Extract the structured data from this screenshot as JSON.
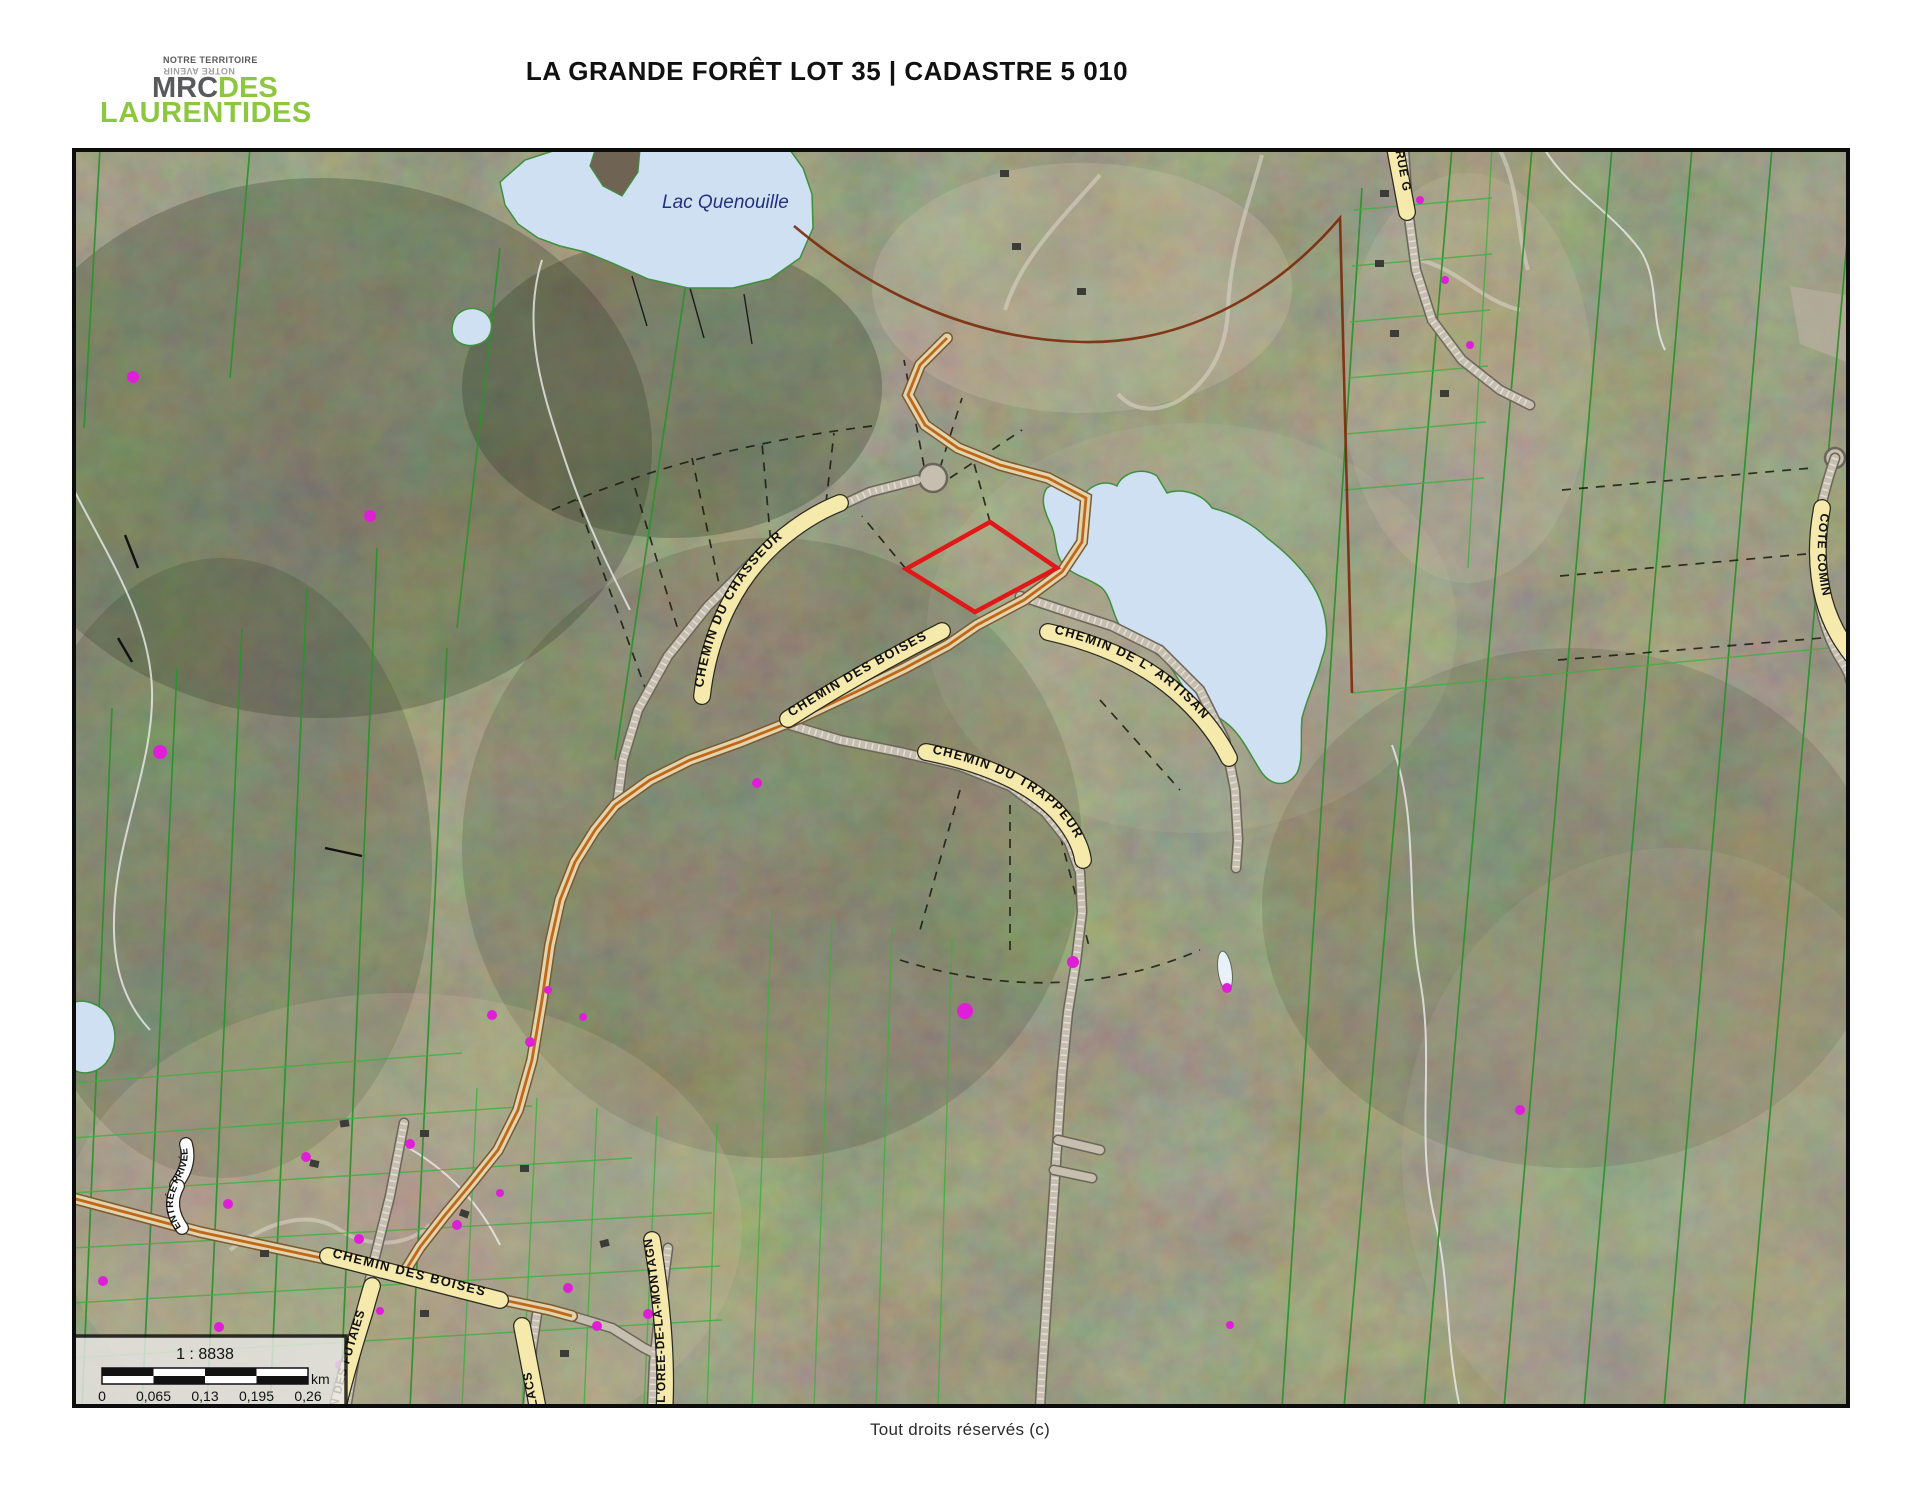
{
  "header": {
    "logo": {
      "tagline1": "NOTRE TERRITOIRE",
      "tagline2": "NOTRE AVENIR",
      "mrc": "MRC",
      "des": "DES",
      "region": "LAURENTIDES"
    },
    "title": "LA GRANDE FORÊT LOT 35 | CADASTRE 5 010"
  },
  "map": {
    "water_labels": {
      "lac_quenouille": "Lac Quenouille"
    },
    "road_labels": {
      "chasseur": "CHEMIN DU CHASSEUR",
      "boises_upper": "CHEMIN DES BOISES",
      "artisan": "CHEMIN DE L' ARTISAN",
      "trappeur": "CHEMIN DU TRAPPEUR",
      "boises_lower": "CHEMIN DES BOISES",
      "futaies": "IN DES FUTAIES",
      "lacs": "LACS",
      "oree": "E L'OREE-DE-LA-MONTAGNE",
      "rue_g": "RUE G",
      "cote": "COTE COMIN",
      "entree": "ENTRÉE",
      "privee": "PRIVÉE"
    },
    "scale_bar": {
      "ratio": "1 : 8838",
      "unit": "km",
      "ticks": [
        "0",
        "0,065",
        "0,13",
        "0,195",
        "0,26"
      ]
    },
    "colors": {
      "water": "#cfe0f2",
      "subject_lot_outline": "#e01818",
      "label_band": "#f5e9ac",
      "cadastral_green": "#2f8f2f",
      "municipal_boundary": "#7a2a0a",
      "address_point": "#df1fd8"
    }
  },
  "footer": {
    "copyright": "Tout droits réservés (c)"
  }
}
